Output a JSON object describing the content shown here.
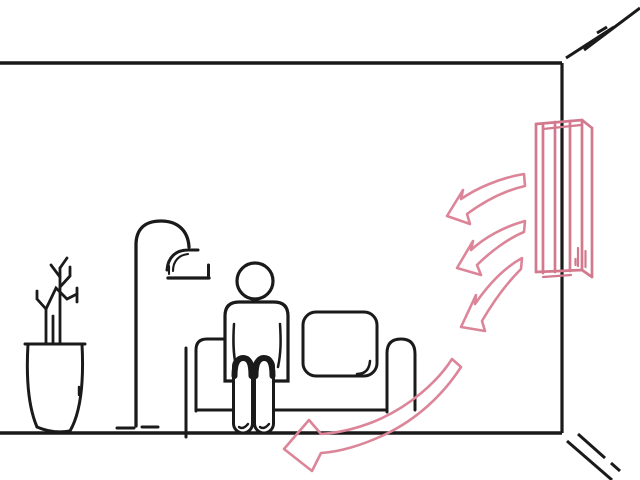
{
  "scene": {
    "title": "Line illustration: wall-mounted air conditioner blowing air into a living room with a seated person on a sofa, a floor lamp and a potted plant",
    "colors": {
      "background": "#ffffff",
      "line_ink": "#1a1a1a",
      "air_conditioner_pink": "#d2798e",
      "airflow_arrow_pink": "#dc8599"
    },
    "airflow_arrow_count": 4,
    "objects": [
      "room-outline",
      "wall-corner-speed-lines",
      "potted-plant",
      "floor-lamp",
      "sofa",
      "seated-person",
      "wall-air-conditioner",
      "airflow-arrows"
    ]
  }
}
